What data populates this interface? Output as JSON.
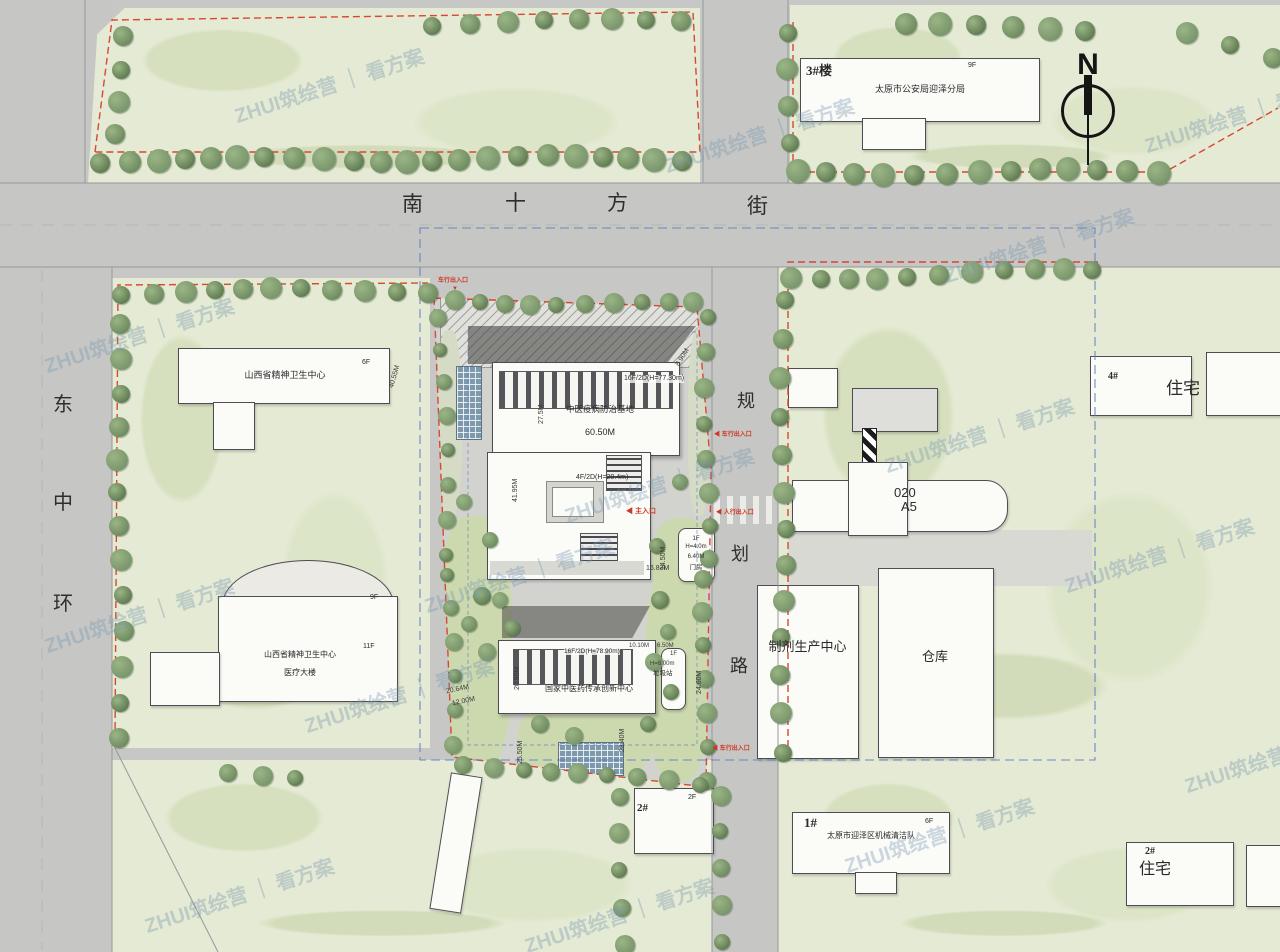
{
  "watermark": {
    "text": "ZHUI筑绘营 ｜ 看方案"
  },
  "north_label": "N",
  "icons": {
    "arrow_left": "◀",
    "arrow_down": "▼"
  },
  "streets": {
    "south": [
      "南",
      "十",
      "方",
      "街"
    ],
    "west": [
      "东",
      "中",
      "环"
    ],
    "middle": [
      "规",
      "划",
      "路"
    ]
  },
  "buildings": {
    "police": {
      "tag": "3#楼",
      "name": "太原市公安局迎泽分局",
      "floors": "9F"
    },
    "mental_health_center": {
      "name": "山西省精神卫生中心",
      "floors": "6F"
    },
    "mental_health_hospital": {
      "name": "山西省精神卫生中心",
      "name2": "医疗大楼",
      "floors": "11F",
      "floors2": "9F"
    },
    "epidemic_base": {
      "spec": "16F/2D(H=77.30m)",
      "name": "中医疫病防治基地",
      "width": "60.50M"
    },
    "podium": {
      "spec": "4F/2D(H=20.4m)"
    },
    "innovation_center": {
      "spec": "16F/2D(H=78.90m)",
      "name": "国家中医药传承创新中心"
    },
    "gatehouse": {
      "floors": "1F",
      "height": "H=4.0m",
      "width": "6.40M",
      "name": "门房"
    },
    "waste_station": {
      "dim1": "10.10M",
      "dim2": "6.50M",
      "floors": "1F",
      "height": "H=8.00m",
      "name": "垃圾站"
    },
    "pharma_plant": {
      "name": "制剂生产中心"
    },
    "warehouse": {
      "name": "仓库"
    },
    "a5": {
      "line1": "020",
      "line2": "A5"
    },
    "residence4": {
      "tag": "4#",
      "name": "住宅"
    },
    "residence2": {
      "tag": "2#",
      "name": "住宅"
    },
    "cleaning_team": {
      "tag": "1#",
      "name": "太原市迎泽区机械清洁队",
      "floors": "6F"
    },
    "building2": {
      "tag": "2#",
      "floors": "2F"
    }
  },
  "dims": {
    "d1": "40.55M",
    "d2": "27.5M",
    "d3": "41.95M",
    "d4": "8.90M",
    "d5": "16.83M",
    "d6": "14.50M",
    "d7": "20.95M",
    "d8": "24.60M",
    "d9": "20.64M",
    "d10": "12.00M",
    "d11": "25.50M",
    "d12": "23.40M"
  },
  "entrances": {
    "vehicle": "车行出入口",
    "main": "主入口",
    "pedestrian": "人行出入口"
  }
}
